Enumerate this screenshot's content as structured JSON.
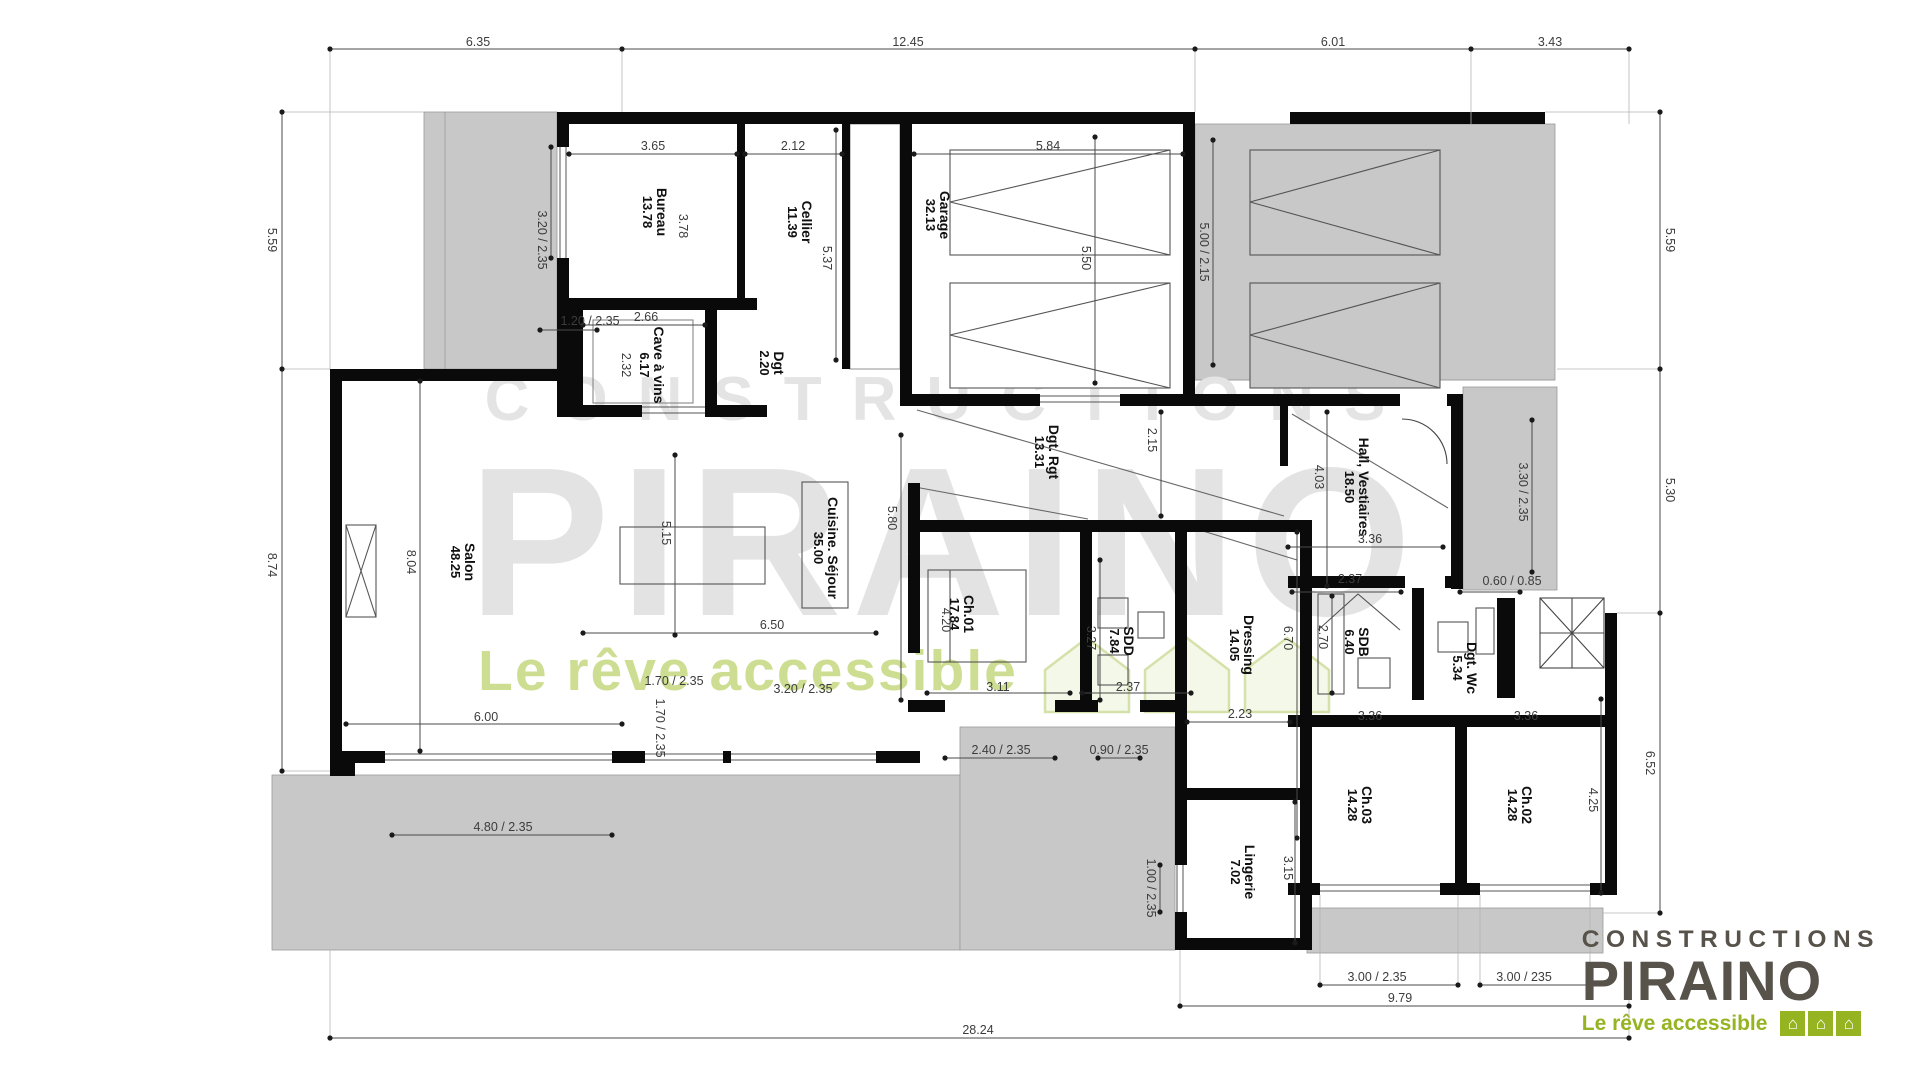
{
  "watermark": {
    "line1": "CONSTRUCTIONS",
    "line2": "PIRAINO",
    "tagline": "Le rêve accessible"
  },
  "logo": {
    "line1": "CONSTRUCTIONS",
    "line2": "PIRAINO",
    "tagline": "Le rêve accessible",
    "house_icon": "⌂"
  },
  "colors": {
    "wall": "#0a0a0a",
    "terrace_gray": "#c8c8c8",
    "dim_text": "#3c3c3c",
    "watermark_gray": "#e4e4e4",
    "watermark_green": "#cdde93",
    "logo_green": "#96b421",
    "logo_text": "#57524a"
  },
  "rooms": [
    {
      "id": "bureau",
      "name": "Bureau",
      "area": "13.78",
      "x": 655,
      "y": 212,
      "rot": 90
    },
    {
      "id": "cellier",
      "name": "Cellier",
      "area": "11.39",
      "x": 800,
      "y": 222,
      "rot": 90
    },
    {
      "id": "garage",
      "name": "Garage",
      "area": "32.13",
      "x": 938,
      "y": 215,
      "rot": 90
    },
    {
      "id": "cave-a-vins",
      "name": "Cave à vins",
      "area": "6.17",
      "x": 652,
      "y": 365,
      "rot": 90
    },
    {
      "id": "dgt",
      "name": "Dgt",
      "area": "2.20",
      "x": 772,
      "y": 363,
      "rot": 90
    },
    {
      "id": "salon",
      "name": "Salon",
      "area": "48.25",
      "x": 463,
      "y": 562,
      "rot": 90
    },
    {
      "id": "cuisine-sejour",
      "name": "Cuisine. Séjour",
      "area": "35.00",
      "x": 826,
      "y": 548,
      "rot": 90
    },
    {
      "id": "dgt-rgt",
      "name": "Dgt. Rgt",
      "area": "13.31",
      "x": 1047,
      "y": 452,
      "rot": 90
    },
    {
      "id": "hall-vestiaires",
      "name": "Hall, Vestiaires",
      "area": "18.50",
      "x": 1357,
      "y": 487,
      "rot": 90
    },
    {
      "id": "ch01",
      "name": "Ch.01",
      "area": "17.84",
      "x": 962,
      "y": 614,
      "rot": 90
    },
    {
      "id": "sdd",
      "name": "SDD",
      "area": "7.84",
      "x": 1122,
      "y": 641,
      "rot": 90
    },
    {
      "id": "dressing",
      "name": "Dressing",
      "area": "14.05",
      "x": 1242,
      "y": 645,
      "rot": 90
    },
    {
      "id": "sdb",
      "name": "SDB",
      "area": "6.40",
      "x": 1357,
      "y": 642,
      "rot": 90
    },
    {
      "id": "dgt-wc",
      "name": "Dgt. Wc",
      "area": "5.34",
      "x": 1465,
      "y": 668,
      "rot": 90
    },
    {
      "id": "lingerie",
      "name": "Lingerie",
      "area": "7.02",
      "x": 1243,
      "y": 872,
      "rot": 90
    },
    {
      "id": "ch03",
      "name": "Ch.03",
      "area": "14.28",
      "x": 1360,
      "y": 805,
      "rot": 90
    },
    {
      "id": "ch02",
      "name": "Ch.02",
      "area": "14.28",
      "x": 1520,
      "y": 805,
      "rot": 90
    }
  ],
  "dims": [
    {
      "t": "6.35",
      "x": 478,
      "y": 42
    },
    {
      "t": "12.45",
      "x": 908,
      "y": 42
    },
    {
      "t": "6.01",
      "x": 1333,
      "y": 42
    },
    {
      "t": "3.43",
      "x": 1550,
      "y": 42
    },
    {
      "t": "5.59",
      "x": 272,
      "y": 240,
      "r": 90
    },
    {
      "t": "8.74",
      "x": 272,
      "y": 565,
      "r": 90
    },
    {
      "t": "5.59",
      "x": 1670,
      "y": 240,
      "r": 90
    },
    {
      "t": "5.30",
      "x": 1670,
      "y": 490,
      "r": 90
    },
    {
      "t": "6.52",
      "x": 1650,
      "y": 763,
      "r": 90
    },
    {
      "t": "28.24",
      "x": 978,
      "y": 1030
    },
    {
      "t": "9.79",
      "x": 1400,
      "y": 998
    },
    {
      "t": "3.65",
      "x": 653,
      "y": 146
    },
    {
      "t": "2.12",
      "x": 793,
      "y": 146
    },
    {
      "t": "5.84",
      "x": 1048,
      "y": 146
    },
    {
      "t": "5.50",
      "x": 1086,
      "y": 258,
      "r": 90
    },
    {
      "t": "5.00 / 2.15",
      "x": 1204,
      "y": 252,
      "r": 90
    },
    {
      "t": "5.37",
      "x": 827,
      "y": 258,
      "r": 90
    },
    {
      "t": "3.78",
      "x": 683,
      "y": 226,
      "r": 90
    },
    {
      "t": "3.20 / 2.35",
      "x": 542,
      "y": 240,
      "r": 90
    },
    {
      "t": "1.20 / 2.35",
      "x": 590,
      "y": 321
    },
    {
      "t": "2.66",
      "x": 646,
      "y": 317
    },
    {
      "t": "2.32",
      "x": 626,
      "y": 365,
      "r": 90
    },
    {
      "t": "8.04",
      "x": 411,
      "y": 562,
      "r": 90
    },
    {
      "t": "5.15",
      "x": 666,
      "y": 533,
      "r": 90
    },
    {
      "t": "5.80",
      "x": 892,
      "y": 518,
      "r": 90
    },
    {
      "t": "6.50",
      "x": 772,
      "y": 625
    },
    {
      "t": "2.15",
      "x": 1152,
      "y": 440,
      "r": 90
    },
    {
      "t": "4.03",
      "x": 1319,
      "y": 477,
      "r": 90
    },
    {
      "t": "3.36",
      "x": 1370,
      "y": 539
    },
    {
      "t": "3.30 / 2.35",
      "x": 1523,
      "y": 492,
      "r": 90
    },
    {
      "t": "0.60 / 0.85",
      "x": 1512,
      "y": 581
    },
    {
      "t": "4.20",
      "x": 946,
      "y": 620,
      "r": 90
    },
    {
      "t": "3.27",
      "x": 1091,
      "y": 638,
      "r": 90
    },
    {
      "t": "6.70",
      "x": 1288,
      "y": 638,
      "r": 90
    },
    {
      "t": "2.37",
      "x": 1350,
      "y": 579
    },
    {
      "t": "2.70",
      "x": 1323,
      "y": 637,
      "r": 90
    },
    {
      "t": "3.11",
      "x": 998,
      "y": 687
    },
    {
      "t": "2.37",
      "x": 1128,
      "y": 687
    },
    {
      "t": "2.23",
      "x": 1240,
      "y": 714
    },
    {
      "t": "3.36",
      "x": 1370,
      "y": 716
    },
    {
      "t": "3.36",
      "x": 1526,
      "y": 716
    },
    {
      "t": "1.70 / 2.35",
      "x": 674,
      "y": 681
    },
    {
      "t": "1.70 / 2.35",
      "x": 660,
      "y": 728,
      "r": 90
    },
    {
      "t": "3.20 / 2.35",
      "x": 803,
      "y": 689
    },
    {
      "t": "6.00",
      "x": 486,
      "y": 717
    },
    {
      "t": "2.40 / 2.35",
      "x": 1001,
      "y": 750
    },
    {
      "t": "0.90 / 2.35",
      "x": 1119,
      "y": 750
    },
    {
      "t": "1.00 / 2.35",
      "x": 1151,
      "y": 888,
      "r": 90
    },
    {
      "t": "3.15",
      "x": 1288,
      "y": 868,
      "r": 90
    },
    {
      "t": "4.80 / 2.35",
      "x": 503,
      "y": 827
    },
    {
      "t": "4.25",
      "x": 1593,
      "y": 800,
      "r": 90
    },
    {
      "t": "3.00 / 2.35",
      "x": 1377,
      "y": 977
    },
    {
      "t": "3.00 / 235",
      "x": 1524,
      "y": 977
    }
  ]
}
